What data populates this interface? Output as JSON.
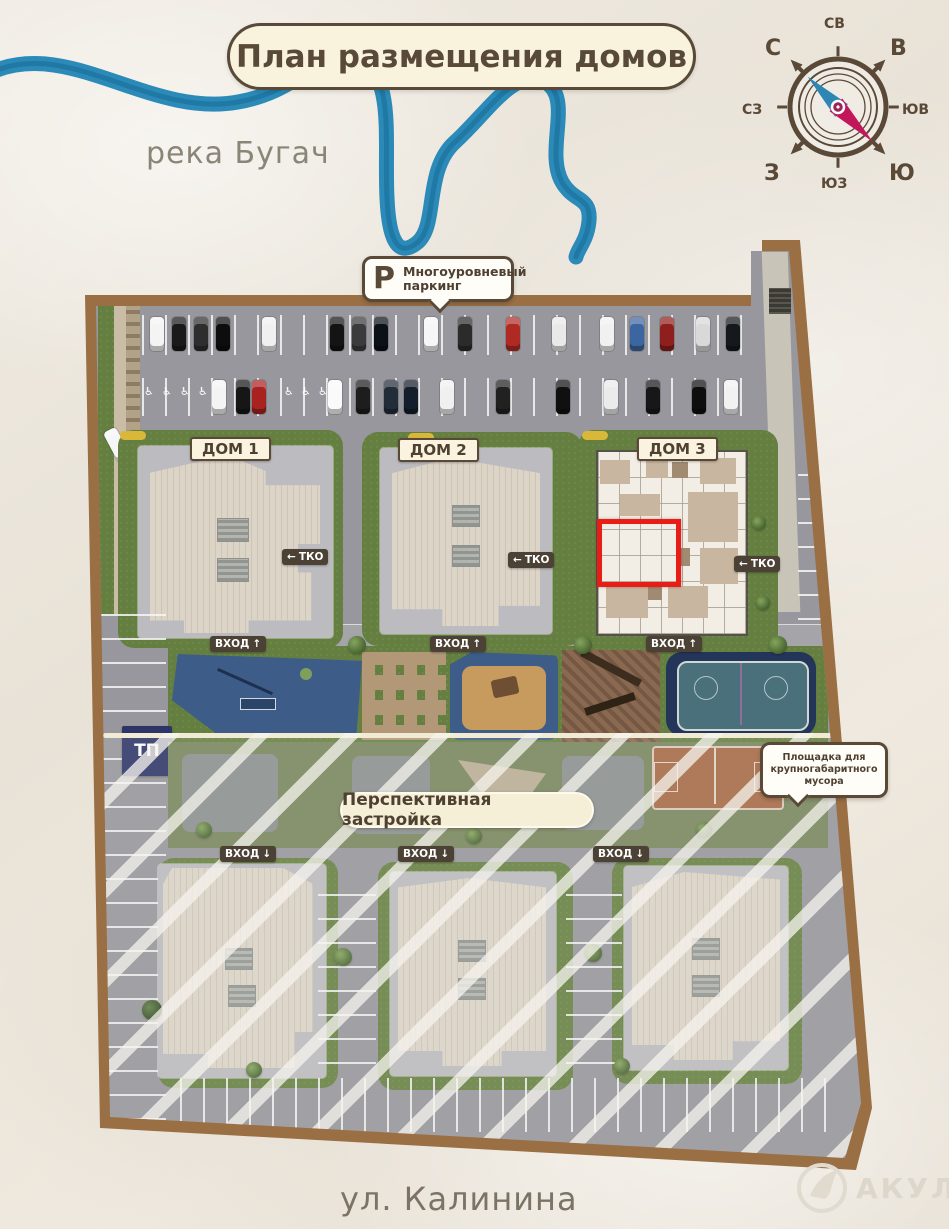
{
  "title": "План размещения домов",
  "river": {
    "label": "река Бугач"
  },
  "street": {
    "label": "ул. Калинина"
  },
  "compass": {
    "n": "С",
    "ne": "СВ",
    "e": "В",
    "se": "ЮВ",
    "s": "Ю",
    "sw": "ЮЗ",
    "w": "З",
    "nw": "СЗ"
  },
  "parking_callout": {
    "icon": "P",
    "line1": "Многоуровневый",
    "line2": "паркинг"
  },
  "houses": [
    {
      "label": "ДОМ 1"
    },
    {
      "label": "ДОМ 2"
    },
    {
      "label": "ДОМ 3"
    }
  ],
  "badges": {
    "entrance": "ВХОД",
    "arrow_up": "↑",
    "arrow_down": "↓",
    "tko": "ТКО",
    "tko_arrow": "←",
    "tp": "ТП"
  },
  "perspective": {
    "label": "Перспективная застройка"
  },
  "garbage_callout": {
    "line1": "Площадка для",
    "line2": "крупногабаритного",
    "line3": "мусора"
  },
  "watermark": {
    "label": "АКУЛА"
  },
  "accessible_icon": "♿",
  "colors": {
    "boundary": "#9b6f44",
    "river": "#2b8ab8",
    "highlight": "#ea1c16",
    "title_brown": "#584938"
  }
}
